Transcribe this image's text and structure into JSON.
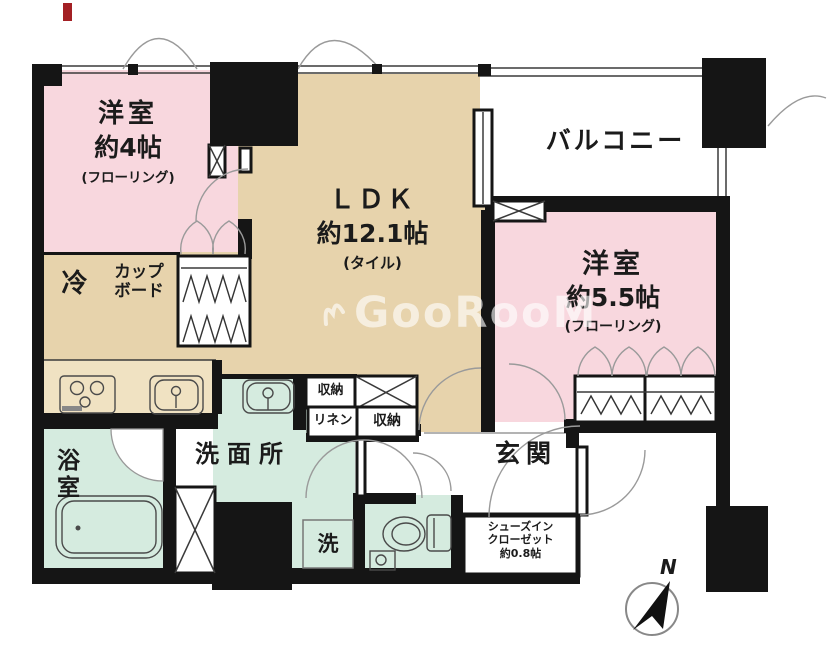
{
  "watermark": {
    "text": "GooRooM"
  },
  "compass": {
    "north_label": "N"
  },
  "rooms": {
    "bedroom1": {
      "name": "洋室",
      "size": "約4帖",
      "floor_note": "(フローリング)"
    },
    "ldk": {
      "name": "ＬＤＫ",
      "size": "約12.1帖",
      "floor_note": "(タイル)"
    },
    "balcony": {
      "name": "バルコニー"
    },
    "bedroom2": {
      "name": "洋室",
      "size": "約5.5帖",
      "floor_note": "(フローリング)"
    },
    "bathroom": {
      "name": "浴室"
    },
    "washroom": {
      "name": "洗面所"
    },
    "entrance": {
      "name": "玄関"
    },
    "shoe_closet": {
      "line1": "シューズイン",
      "line2": "クローゼット",
      "line3": "約0.8帖"
    }
  },
  "labels": {
    "refrigerator": "冷",
    "cupboard_line1": "カップ",
    "cupboard_line2": "ボード",
    "storage_upper": "収納",
    "linen": "リネン",
    "storage_lower": "収納",
    "laundry": "洗"
  },
  "colors": {
    "room_pink": "#f8d7de",
    "floor_beige": "#e7d3ac",
    "counter_beige": "#f0e2c2",
    "wet_green": "#d5ebdf",
    "wall_black": "#151515",
    "watermark_white": "rgba(255,255,255,0.62)",
    "red_mark": "#a32024"
  }
}
